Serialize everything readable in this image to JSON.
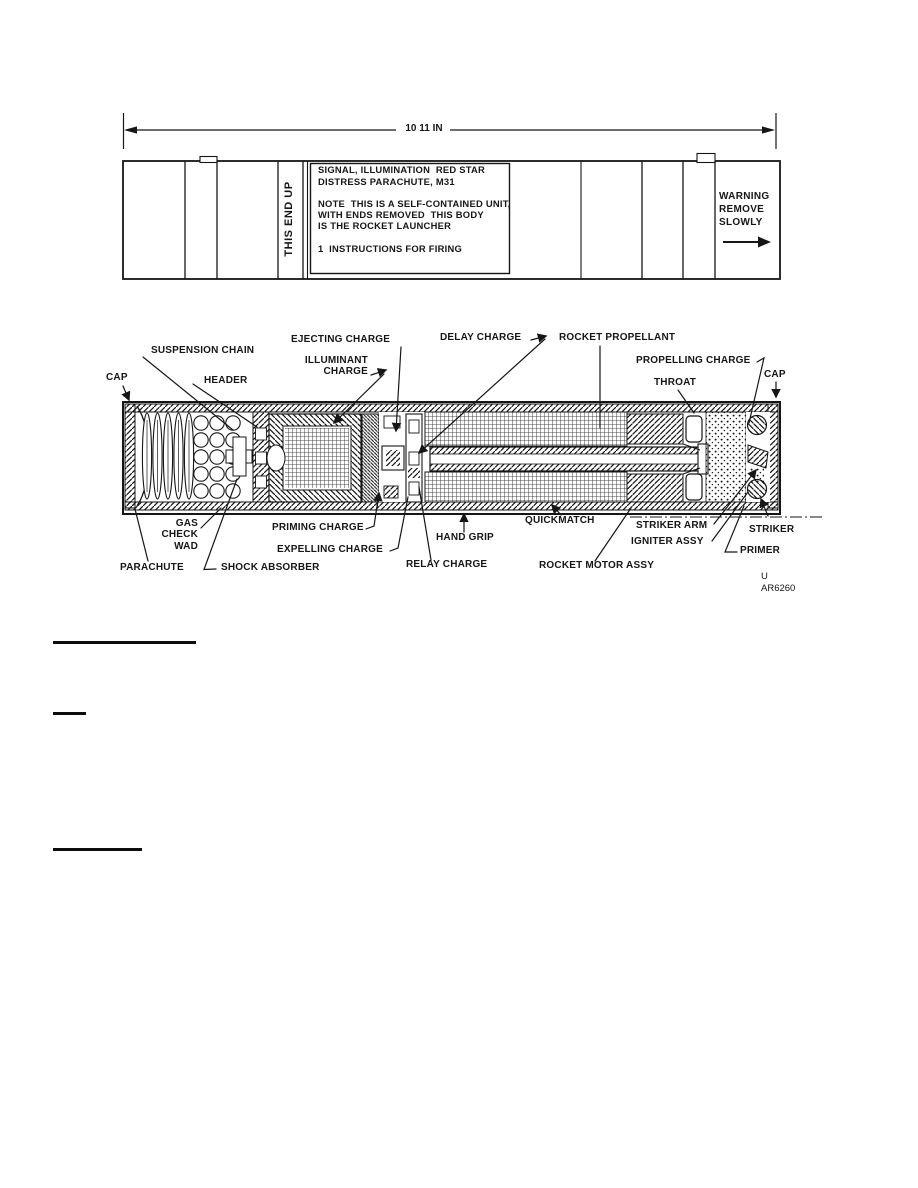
{
  "page": {
    "background": "#ffffff",
    "ink": "#161616"
  },
  "dimension": {
    "label": "10 11 IN"
  },
  "tube": {
    "this_end_up": "THIS END UP",
    "label_box": {
      "line1": "SIGNAL, ILLUMINATION  RED STAR",
      "line2": "DISTRESS PARACHUTE, M31",
      "line3": "NOTE  THIS IS A SELF-CONTAINED UNIT,",
      "line4": "WITH ENDS REMOVED  THIS BODY",
      "line5": "IS THE ROCKET LAUNCHER",
      "line6": "1  INSTRUCTIONS FOR FIRING"
    },
    "warning": {
      "line1": "WARNING",
      "line2": "REMOVE",
      "line3": "SLOWLY"
    }
  },
  "cutaway": {
    "callouts": {
      "cap_left": "CAP",
      "suspension_chain": "SUSPENSION CHAIN",
      "header": "HEADER",
      "ejecting_charge": "EJECTING CHARGE",
      "illuminant_line1": "ILLUMINANT",
      "illuminant_line2": "CHARGE",
      "delay_charge": "DELAY CHARGE",
      "rocket_propellant": "ROCKET PROPELLANT",
      "propelling_charge": "PROPELLING CHARGE",
      "throat": "THROAT",
      "cap_right": "CAP",
      "gas_line1": "GAS",
      "gas_line2": "CHECK",
      "gas_line3": "WAD",
      "parachute": "PARACHUTE",
      "shock_absorber": "SHOCK ABSORBER",
      "priming_charge": "PRIMING CHARGE",
      "expelling_charge": "EXPELLING CHARGE",
      "relay_charge": "RELAY CHARGE",
      "hand_grip": "HAND GRIP",
      "quickmatch": "QUICKMATCH",
      "striker_arm": "STRIKER ARM",
      "igniter_assy": "IGNITER ASSY",
      "rocket_motor_assy": "ROCKET MOTOR ASSY",
      "striker": "STRIKER",
      "primer": "PRIMER"
    },
    "figure_ref": {
      "line1": "U",
      "line2": "AR6260"
    }
  }
}
